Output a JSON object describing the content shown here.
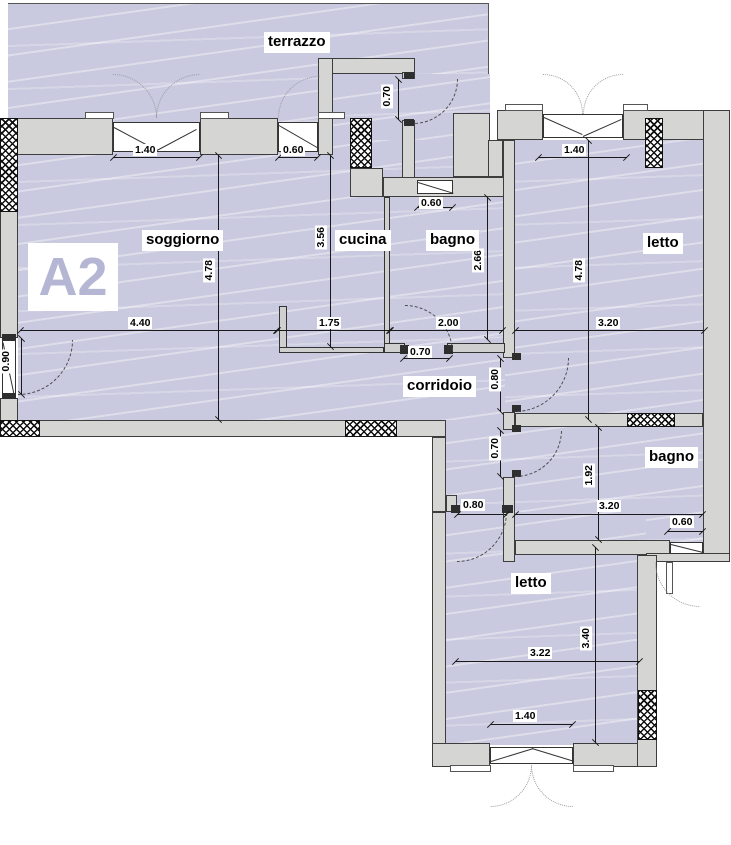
{
  "plan": {
    "unit_label": "A2",
    "rooms": {
      "terrazzo": "terrazzo",
      "soggiorno": "soggiorno",
      "cucina": "cucina",
      "bagno1": "bagno",
      "letto1": "letto",
      "corridoio": "corridoio",
      "bagno2": "bagno",
      "letto2": "letto"
    },
    "dims": {
      "terrace_window_w": "1.40",
      "terrace_window2_w": "0.60",
      "entry_door_w": "0.70",
      "letto1_window_w": "1.40",
      "bagno1_window_w": "0.60",
      "soggiorno_h": "4.78",
      "cucina_h": "3.56",
      "bagno1_h": "2.66",
      "letto1_h": "4.78",
      "soggiorno_w": "4.40",
      "cucina_w": "1.75",
      "bagno1_w": "2.00",
      "letto1_w": "3.20",
      "left_door_w": "0.90",
      "bagno1_door_w": "0.70",
      "letto1_door_w": "0.80",
      "bagno2_door_w": "0.70",
      "letto2_door_w": "0.80",
      "bagno2_h": "1.92",
      "bagno2_w": "3.20",
      "bagno2_window_w": "0.60",
      "letto2_w": "3.22",
      "letto2_h": "3.40",
      "letto2_window_w": "1.40"
    },
    "colors": {
      "floor": "#c9c9df",
      "wall": "#d5d5d3",
      "unit_label": "#b4b6d4",
      "hatch": "#111111",
      "dimension_line": "#1a1a1a"
    }
  }
}
